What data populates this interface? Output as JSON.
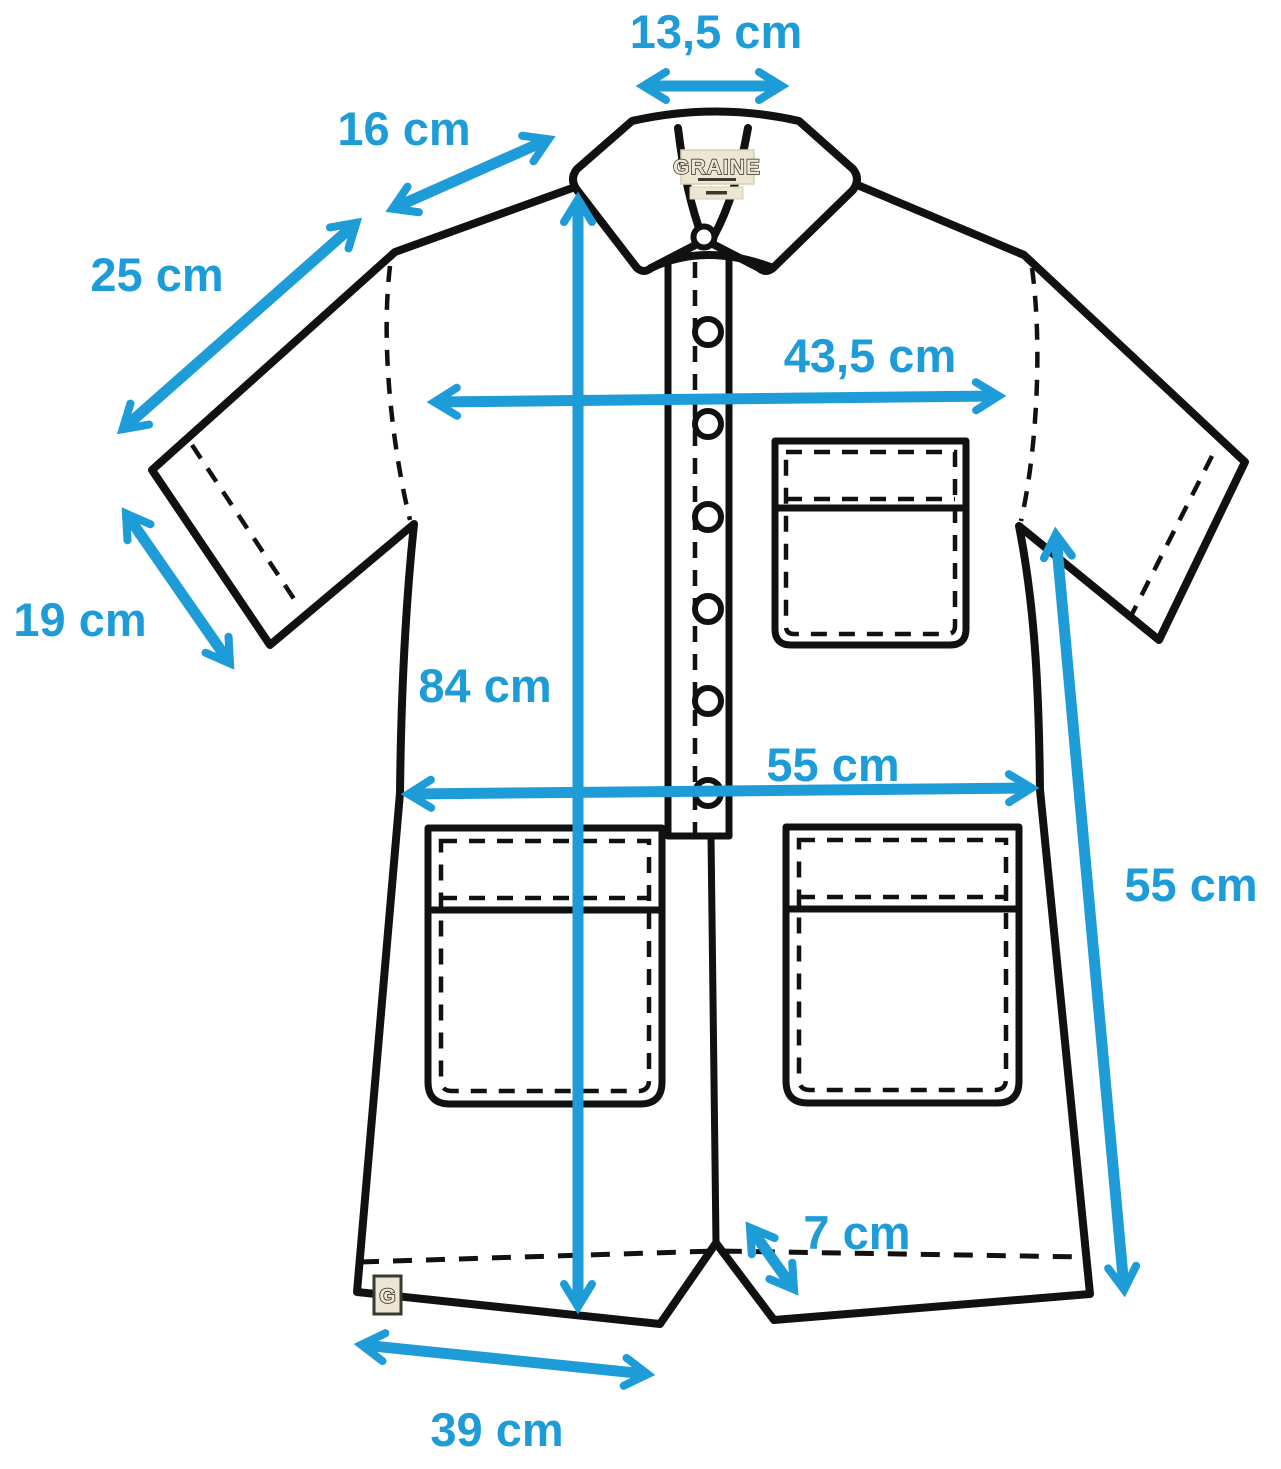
{
  "colors": {
    "accent_blue": "#1E9CD8",
    "outline_black": "#111111",
    "label_beige": "#EDE6D2"
  },
  "brand": {
    "collar_label": "GRAINE",
    "hem_tag": "G"
  },
  "measurements": {
    "collar_width": "13,5 cm",
    "collar_point": "16 cm",
    "shoulder_seam": "25 cm",
    "sleeve_opening": "19 cm",
    "chest_width": "43,5 cm",
    "front_length": "84 cm",
    "hip_width": "55 cm",
    "side_length": "55 cm",
    "leg_slit": "7 cm",
    "leg_hem_width": "39 cm"
  }
}
